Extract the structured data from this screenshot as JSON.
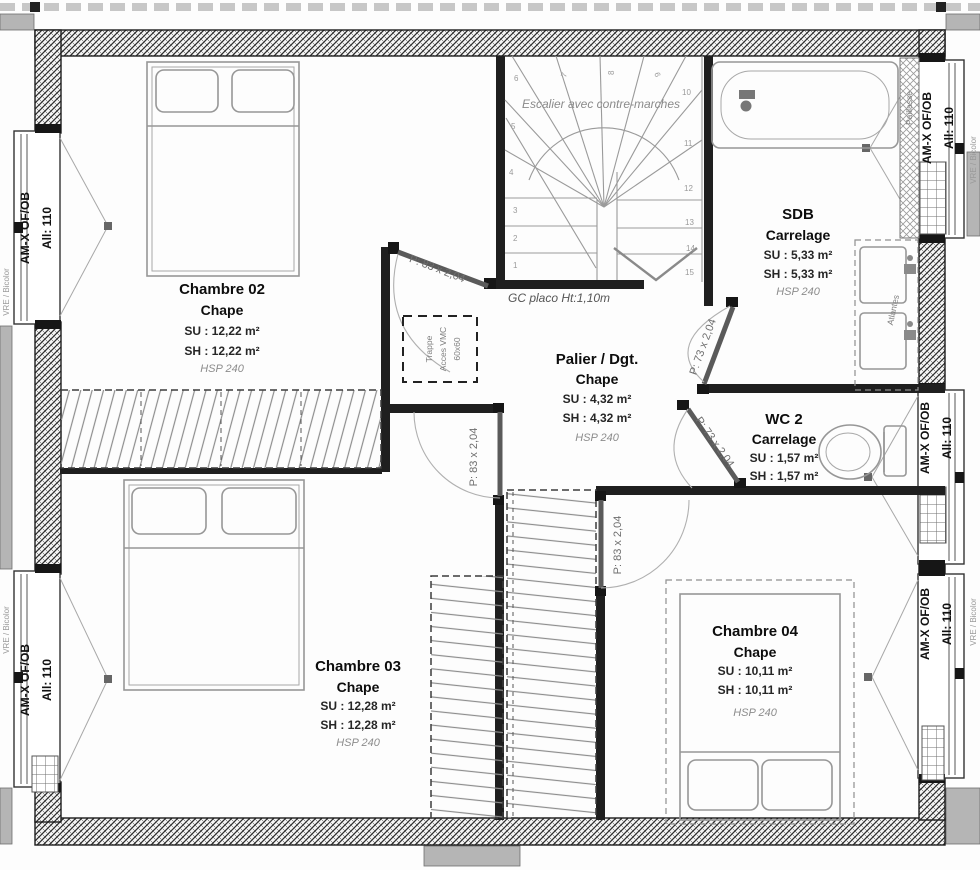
{
  "rooms": [
    {
      "name": "Chambre 02",
      "finish": "Chape",
      "su": "SU : 12,22 m²",
      "sh": "SH : 12,22 m²",
      "hsp": "HSP 240"
    },
    {
      "name": "SDB",
      "finish": "Carrelage",
      "su": "SU : 5,33 m²",
      "sh": "SH : 5,33 m²",
      "hsp": "HSP 240"
    },
    {
      "name": "Palier / Dgt.",
      "finish": "Chape",
      "su": "SU : 4,32 m²",
      "sh": "SH : 4,32 m²",
      "hsp": "HSP 240"
    },
    {
      "name": "WC 2",
      "finish": "Carrelage",
      "su": "SU : 1,57 m²",
      "sh": "SH : 1,57 m²",
      "hsp": ""
    },
    {
      "name": "Chambre 03",
      "finish": "Chape",
      "su": "SU : 12,28 m²",
      "sh": "SH : 12,28 m²",
      "hsp": "HSP 240"
    },
    {
      "name": "Chambre 04",
      "finish": "Chape",
      "su": "SU : 10,11 m²",
      "sh": "SH : 10,11 m²",
      "hsp": "HSP 240"
    }
  ],
  "door_labels": {
    "p83": "P: 83 x 2,04",
    "p73": "P: 73 x 2,04"
  },
  "window_label": {
    "line1": "AM-X OF/OB",
    "line2": "All: 110"
  },
  "stair": {
    "caption": "Escalier avec contre-marches",
    "note": "GC placo Ht:1,10m",
    "steps": [
      "1",
      "2",
      "3",
      "4",
      "5",
      "6",
      "7",
      "8",
      "9",
      "10",
      "11",
      "12",
      "13",
      "14",
      "15"
    ]
  },
  "annotations": {
    "trappe_line1": "Trappe",
    "trappe_line2": "Acces VMC",
    "trappe_line3": "60x60",
    "paillasse": "Paillasse",
    "atlantes": "Atlantes",
    "vre_bicolor": "VRE / Bicolor"
  },
  "colors": {
    "wall": "#1c1c1c",
    "fixture": "#979797",
    "gray_block": "#b5b5b5",
    "text": "#111111",
    "muted": "#8c8c8c"
  }
}
